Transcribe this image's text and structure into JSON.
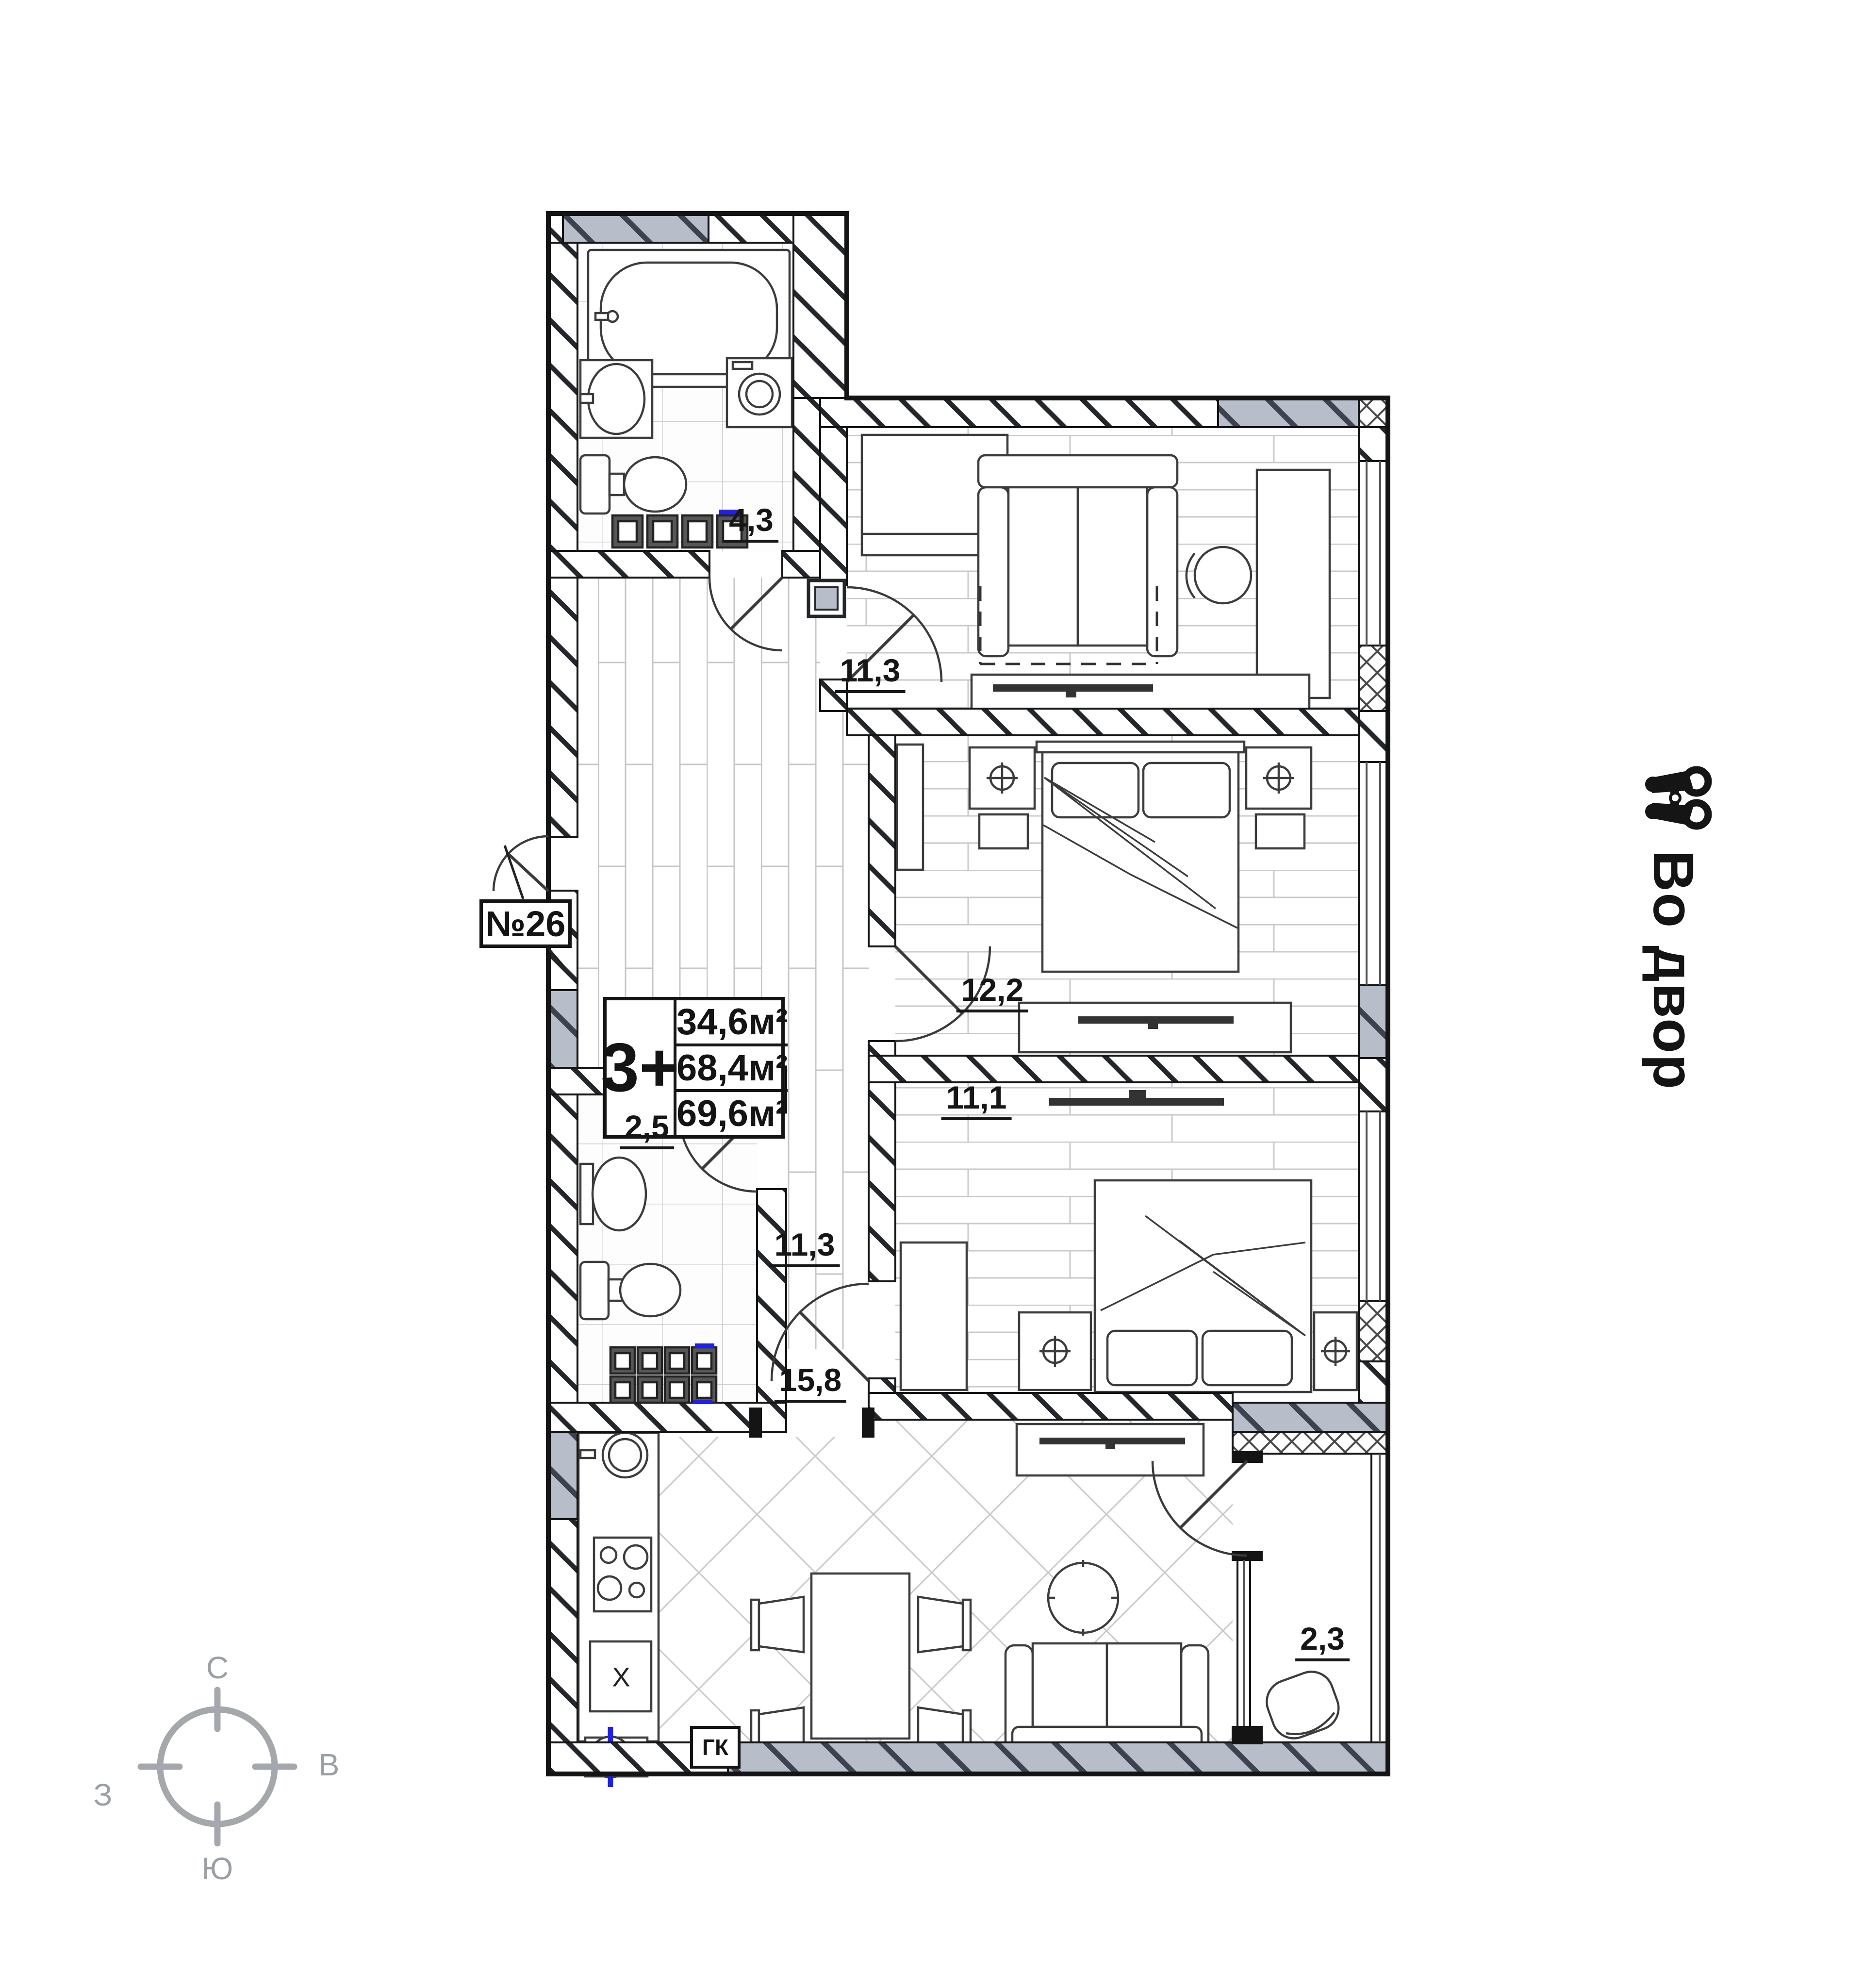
{
  "plan": {
    "apartment_label": "№26",
    "type_label": "3+",
    "areas": {
      "living": "34,6м²",
      "apartment": "68,4м²",
      "total": "69,6м²"
    },
    "room_labels": {
      "bathroom": "4,3",
      "room_top": "11,3",
      "bedroom_mid": "12,2",
      "bedroom_low": "11,1",
      "wc": "2,5",
      "hallway": "11,3",
      "kitchen_living": "15,8",
      "balcony": "2,3"
    },
    "boiler_label": "ГК",
    "fridge_label": "X"
  },
  "annotations": {
    "view_text": "Во двор",
    "view_icon": "binoculars-icon"
  },
  "compass": {
    "n": "С",
    "e": "В",
    "s": "Ю",
    "w": "З"
  },
  "colors": {
    "wall": "#141414",
    "glass_gray": "#b7bec9",
    "accent_blue": "#1f1fe8",
    "compass_gray": "#9ba0a6"
  }
}
